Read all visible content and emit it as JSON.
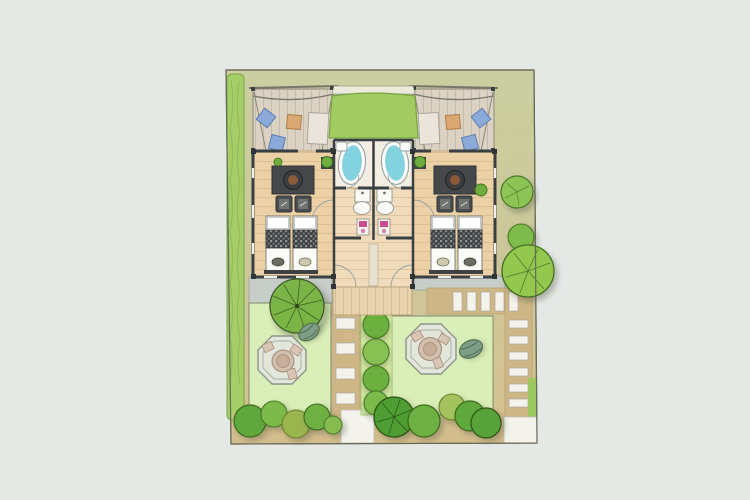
{
  "scene": {
    "kind": "hand-drawn architectural site plan, top-down watercolor style",
    "subject": "two mirrored holiday-lodge units sharing one building: front terraces with lounge cushions, green entrance canopy, twin bathrooms with tubs, living rooms with rug/armchairs, twin beds, central hallway with washbasins and WCs, rear deck, two lawned gardens each with an octagonal patio and a hot-tub barrel, stepping-stone paths, boundary hedge and tree planting"
  },
  "palette": {
    "page_bg": "#e4e9e6",
    "plot_top": "#cbcfa0",
    "plot_mid": "#ccc79b",
    "plot_bottom": "#d6c190",
    "hedge_green": "#a5cd68",
    "lawn_green": "#daefb7",
    "strip_green": "#cfe79f",
    "wood_floor": "#ecd0a6",
    "hall_floor": "#f0dcba",
    "deck_wood": "#e9d3ac",
    "terrace_deck": "#dbd2c3",
    "canopy_green": "#a2cb62",
    "bath_floor": "#f3eee4",
    "tub_blue": "#82d2e0",
    "cushion_blue": "#8ba9d9",
    "table_tan": "#d9a873",
    "rug_dark": "#45484a",
    "wall_dark": "#3a3f42",
    "bed_white": "#fbfbf7",
    "path_tan": "#cfb687",
    "stone_white": "#f3f3ec",
    "pave_gray": "#c7cdc9",
    "octagon_fill": "#e3e6da",
    "octagon_table": "#d2bfae",
    "barrel_green": "#7e9d88",
    "plant_green": "#6fae3e",
    "pink_accent": "#c94f8c",
    "tree_dark": "#5fa93c",
    "tree_mid": "#7cbb4a",
    "tree_light": "#93c74e",
    "tree_olive": "#9ab44e"
  },
  "features": {
    "site": [
      "plot-boundary",
      "hedge-left",
      "lawn-left",
      "lawn-right",
      "stepping-path-center",
      "stepping-path-right",
      "paved-area-left",
      "paved-area-right",
      "shrub-strip-center",
      "tree-row-bottom",
      "trees-right-boundary",
      "walkway-bottom-center",
      "walkway-bottom-right"
    ],
    "building": [
      "terrace-left",
      "terrace-right",
      "entrance-canopy",
      "bathroom-left",
      "bathroom-right",
      "living-room-left",
      "living-room-right",
      "twin-beds-left",
      "twin-beds-right",
      "central-hallway",
      "rear-deck"
    ],
    "garden": [
      "patio-octagon-left",
      "patio-octagon-right",
      "hot-tub-left",
      "hot-tub-right",
      "large-tree-left-lawn"
    ]
  }
}
